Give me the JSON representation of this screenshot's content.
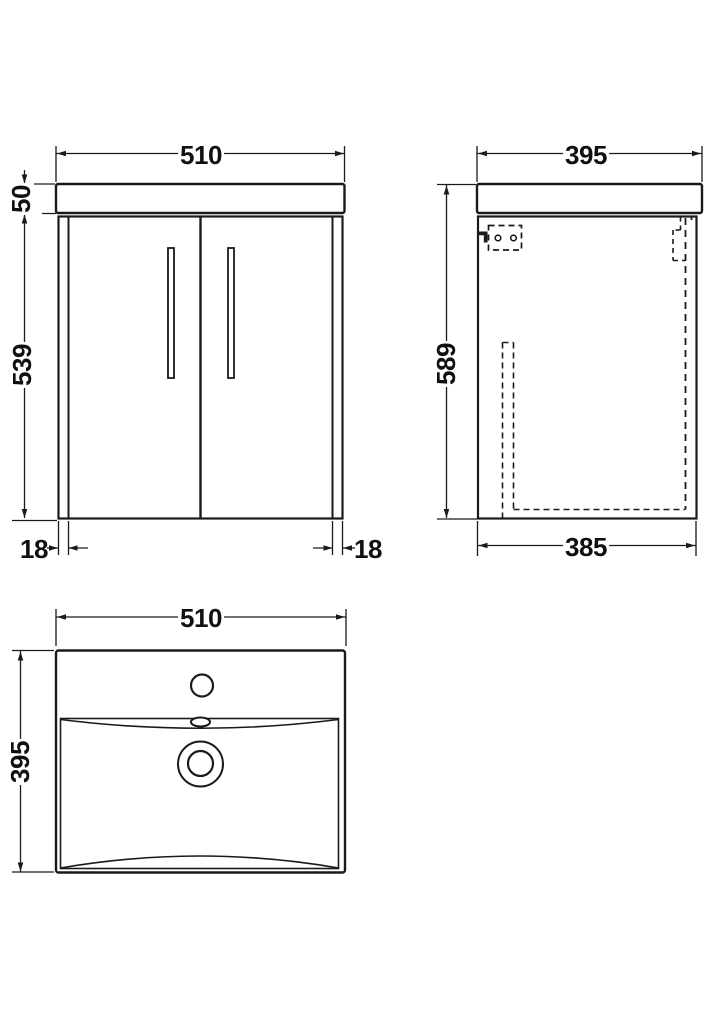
{
  "drawing": {
    "title": "vanity-unit-technical-drawing",
    "line_color": "#1a1a1a",
    "background": "#ffffff",
    "views": {
      "front": {
        "width": "510",
        "worktop_height": "50",
        "body_height": "539",
        "left_panel_thickness": "18",
        "right_panel_thickness": "18"
      },
      "side": {
        "depth": "395",
        "height": "589",
        "body_depth": "385"
      },
      "basin": {
        "width": "510",
        "depth": "395"
      }
    }
  }
}
